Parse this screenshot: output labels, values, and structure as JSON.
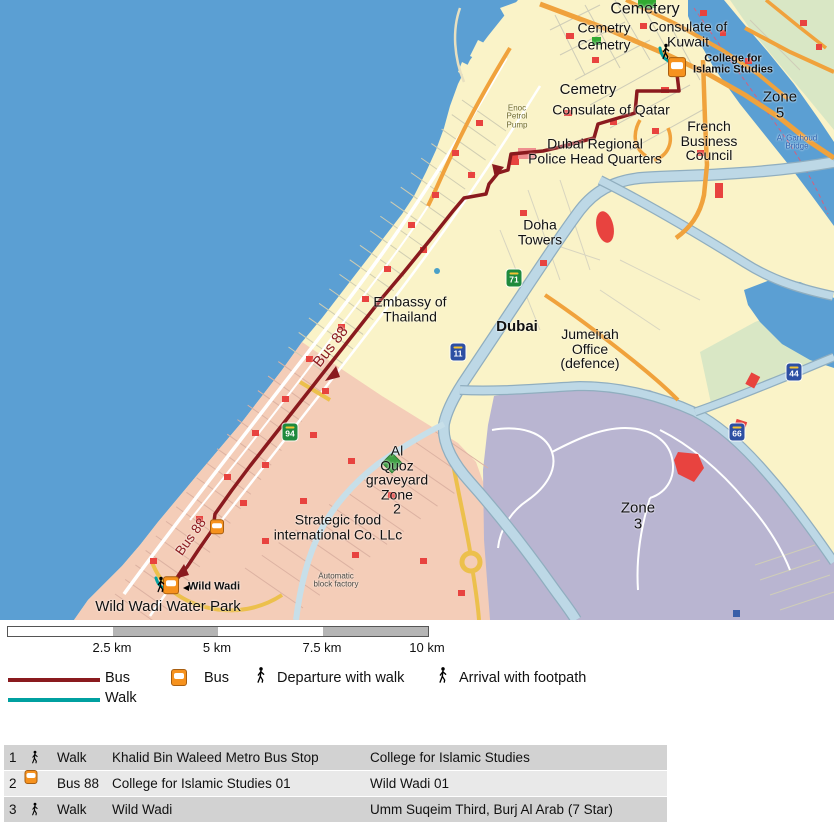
{
  "colors": {
    "sea": "#5b9fd3",
    "land": "#faf3c8",
    "district_pink": "#f4cdb8",
    "zone3_purple": "#b9b5d1",
    "park_green": "#d9e7c5",
    "highway_band": "#bdd8e6",
    "road_orange": "#f0a23c",
    "road_yellow": "#ecc04c",
    "building_red": "#e8433f",
    "bus_route": "#8a1a1e",
    "walk_teal": "#00a0a0",
    "bus_icon_orange": "#f6921e",
    "shield_green": "#1f8a3d",
    "shield_blue": "#2d4fa3"
  },
  "map": {
    "labels": [
      {
        "text": "Cemetery",
        "x": 645,
        "y": 10,
        "size": 16
      },
      {
        "text": "Cemetry",
        "x": 604,
        "y": 28,
        "size": 14
      },
      {
        "text": "Cemetry",
        "x": 604,
        "y": 45,
        "size": 14
      },
      {
        "text": "Consulate of\nKuwait",
        "x": 688,
        "y": 34,
        "size": 14
      },
      {
        "text": "College for\nIslamic Studies",
        "x": 733,
        "y": 65,
        "size": 11,
        "bold": true
      },
      {
        "text": "Cemetry",
        "x": 588,
        "y": 90,
        "size": 15
      },
      {
        "text": "Consulate of Qatar",
        "x": 611,
        "y": 110,
        "size": 14
      },
      {
        "text": "Enoc\nPetrol\nPump",
        "x": 517,
        "y": 117,
        "size": 8,
        "color": "#6e6a2e"
      },
      {
        "text": "Dubai Regional\nPolice Head Quarters",
        "x": 595,
        "y": 151,
        "size": 14
      },
      {
        "text": "French\nBusiness\nCouncil",
        "x": 709,
        "y": 141,
        "size": 14
      },
      {
        "text": "Zone\n5",
        "x": 780,
        "y": 105,
        "size": 15
      },
      {
        "text": "Al Garhoud\nBridge",
        "x": 797,
        "y": 143,
        "size": 8,
        "color": "#2b5fae"
      },
      {
        "text": "Doha\nTowers",
        "x": 540,
        "y": 232,
        "size": 14
      },
      {
        "text": "Embassy of\nThailand",
        "x": 410,
        "y": 309,
        "size": 14
      },
      {
        "text": "Bus 88",
        "x": 331,
        "y": 347,
        "size": 15,
        "color": "#8a1a1e",
        "rotate": -52
      },
      {
        "text": "Dubai",
        "x": 517,
        "y": 327,
        "size": 15,
        "bold": true
      },
      {
        "text": "Jumeirah\nOffice\n(defence)",
        "x": 590,
        "y": 349,
        "size": 14
      },
      {
        "text": "Zone\n3",
        "x": 638,
        "y": 516,
        "size": 15
      },
      {
        "text": "Al\nQuoz\ngraveyard\nZone\n2",
        "x": 397,
        "y": 480,
        "size": 14
      },
      {
        "text": "Strategic food\ninternational Co. LLc",
        "x": 338,
        "y": 527,
        "size": 14
      },
      {
        "text": "Automatic\nblock factory",
        "x": 336,
        "y": 581,
        "size": 8,
        "color": "#4a4a44"
      },
      {
        "text": "Bus 88",
        "x": 191,
        "y": 537,
        "size": 13.5,
        "color": "#8a1a1e",
        "rotate": -54
      },
      {
        "text": "Wild Wadi",
        "x": 214,
        "y": 587,
        "size": 11,
        "bold": true
      },
      {
        "text": "Wild Wadi Water Park",
        "x": 168,
        "y": 607,
        "size": 15
      }
    ],
    "shields": [
      {
        "road": "94",
        "kind": "green",
        "x": 290,
        "y": 432
      },
      {
        "road": "71",
        "kind": "green",
        "x": 514,
        "y": 278
      },
      {
        "road": "11",
        "kind": "blue",
        "x": 458,
        "y": 352
      },
      {
        "road": "44",
        "kind": "blue",
        "x": 794,
        "y": 372
      },
      {
        "road": "66",
        "kind": "blue",
        "x": 737,
        "y": 432
      }
    ],
    "bus_stops": [
      {
        "x": 677,
        "y": 67,
        "s": 18
      },
      {
        "x": 217,
        "y": 527,
        "s": 14
      },
      {
        "x": 171,
        "y": 585,
        "s": 16
      }
    ],
    "walkers": [
      {
        "x": 661,
        "y": 43
      },
      {
        "x": 156,
        "y": 576
      }
    ],
    "poi_dots": [
      {
        "x": 186,
        "y": 588
      }
    ]
  },
  "scalebar": {
    "ticks": [
      "2.5 km",
      "5 km",
      "7.5 km",
      "10 km"
    ]
  },
  "legend": {
    "bus_line": "Bus",
    "walk_line": "Walk",
    "bus_icon": "Bus",
    "departure": "Departure with walk",
    "arrival": "Arrival with footpath"
  },
  "itinerary": {
    "rows": [
      {
        "num": "1",
        "icon": "walk",
        "mode": "Walk",
        "from": "Khalid Bin Waleed Metro Bus Stop",
        "to": "College for Islamic Studies"
      },
      {
        "num": "2",
        "icon": "bus",
        "mode": "Bus 88",
        "from": "College for Islamic Studies 01",
        "to": "Wild Wadi 01"
      },
      {
        "num": "3",
        "icon": "walk",
        "mode": "Walk",
        "from": "Wild Wadi",
        "to": "Umm Suqeim Third, Burj Al Arab (7 Star)"
      }
    ]
  }
}
